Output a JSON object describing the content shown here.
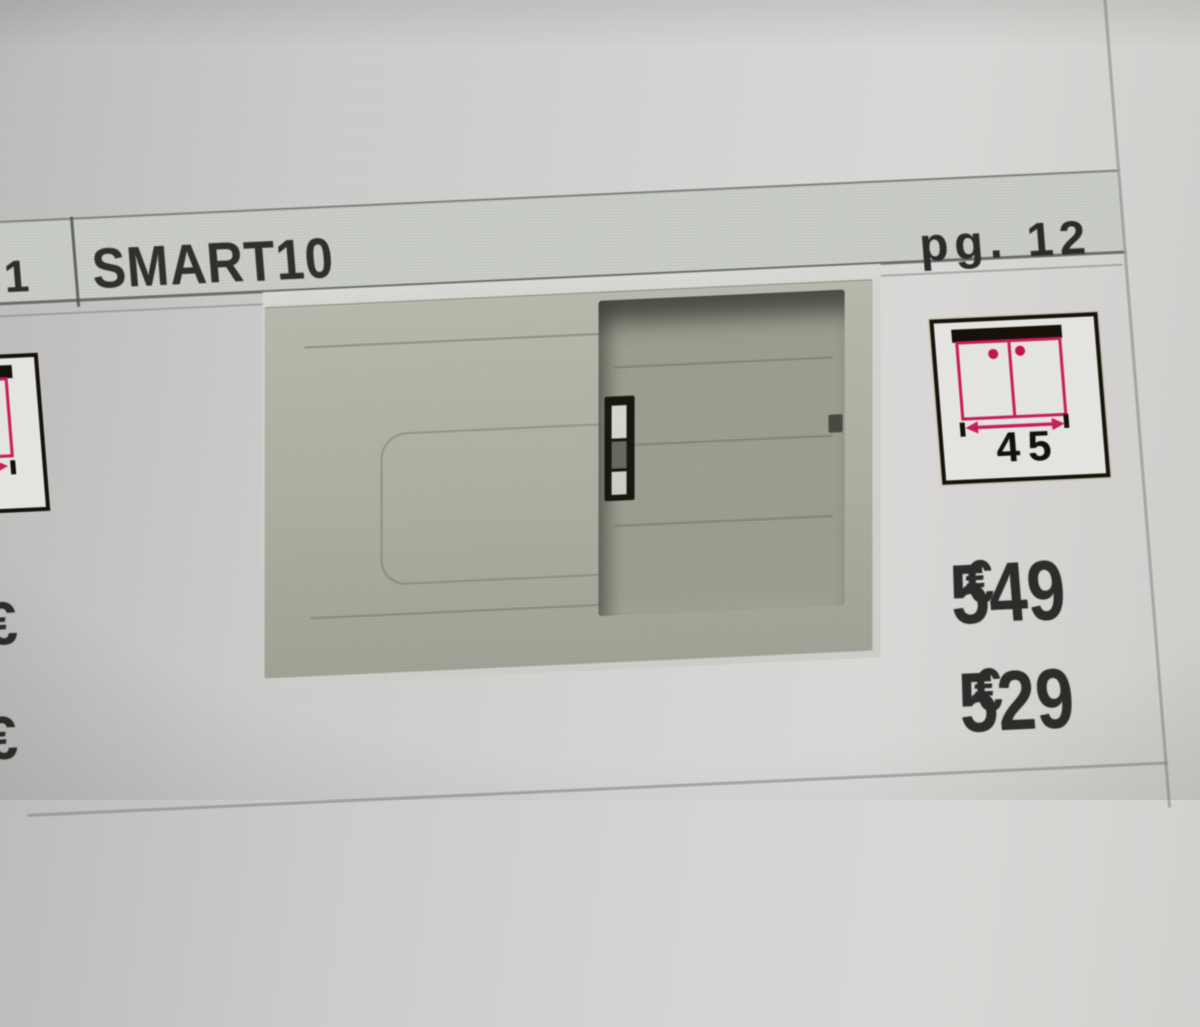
{
  "header": {
    "row_number": "1",
    "product_name": "SMART10",
    "page_label": "pg. 12"
  },
  "size_icon": {
    "width_value": "45"
  },
  "prices": {
    "top": {
      "amount": "549",
      "currency": "€"
    },
    "bottom": {
      "amount": "529",
      "currency": "€"
    }
  },
  "left_column": {
    "partial_euro_top": "€",
    "partial_euro_bottom": "€"
  },
  "colors": {
    "paper": "#d2d1cf",
    "header_band": "#cacdc8",
    "accent_pink": "#c71e59",
    "icon_border": "#17130c",
    "text": "#2c2d2a",
    "sink_body": "#aeaea2",
    "bowl_interior": "#9c9d90",
    "photo_background": "#d3d4cf"
  }
}
